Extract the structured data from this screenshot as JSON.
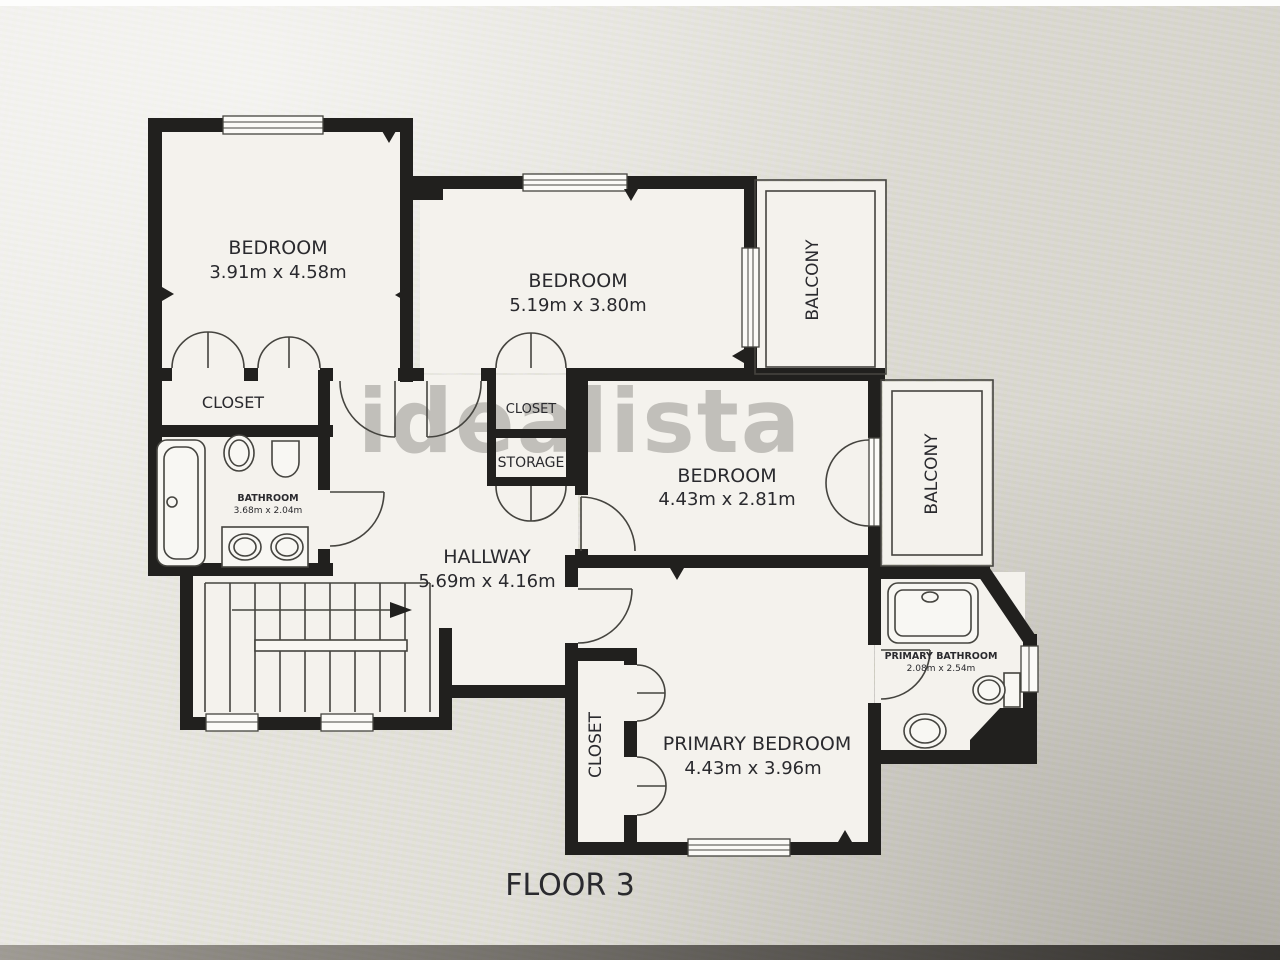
{
  "meta": {
    "floor_label": "FLOOR 3",
    "watermark": "idealista"
  },
  "rooms": {
    "bedroom_top_left": {
      "label": "BEDROOM",
      "dims": "3.91m x 4.58m"
    },
    "bedroom_top_middle": {
      "label": "BEDROOM",
      "dims": "5.19m x 3.80m"
    },
    "bedroom_middle_right": {
      "label": "BEDROOM",
      "dims": "4.43m x 2.81m"
    },
    "primary_bedroom": {
      "label": "PRIMARY BEDROOM",
      "dims": "4.43m x 3.96m"
    },
    "hallway": {
      "label": "HALLWAY",
      "dims": "5.69m x 4.16m"
    },
    "bathroom": {
      "label": "BATHROOM",
      "dims": "3.68m x 2.04m"
    },
    "primary_bathroom": {
      "label": "PRIMARY BATHROOM",
      "dims": "2.08m x 2.54m"
    },
    "closet_left": {
      "label": "CLOSET"
    },
    "closet_middle": {
      "label": "CLOSET"
    },
    "storage": {
      "label": "STORAGE"
    },
    "closet_primary": {
      "label": "CLOSET"
    },
    "balcony_top": {
      "label": "BALCONY"
    },
    "balcony_right": {
      "label": "BALCONY"
    }
  },
  "colors": {
    "wall": "#21201e",
    "floor": "#f4f2ed",
    "background": "#e9e7e2",
    "line": "#45443f",
    "text": "#2a2a2e",
    "watermark": "#8f8d88"
  }
}
